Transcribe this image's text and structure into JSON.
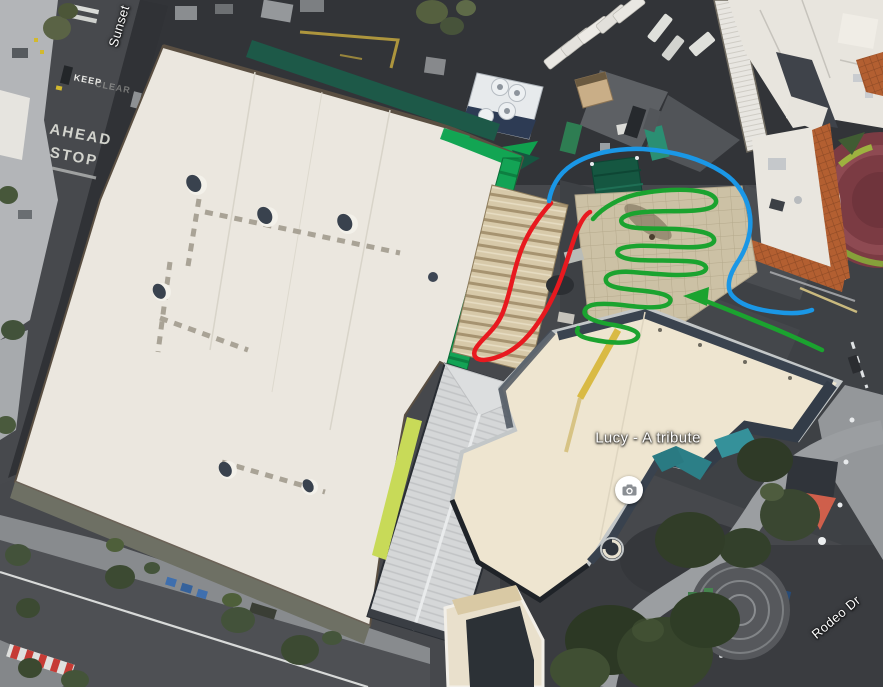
{
  "view": {
    "type": "satellite-imagery",
    "description": "Aerial map view with hand-drawn route annotations"
  },
  "labels": {
    "sunset_street": "Sunset",
    "rodeo_street": "Rodeo Dr",
    "poi_lucy": "Lucy - A tribute"
  },
  "road_markings": {
    "keep": "KEEP",
    "clear": "CLEAR",
    "ahead": "AHEAD",
    "stop": "STOP"
  },
  "icons": {
    "poi_photo": "camera-icon"
  },
  "annotations": {
    "colors": {
      "red": "#e8191f",
      "blue": "#1a97e6",
      "green": "#1ba32f"
    },
    "red_loop_path": "M551 203 C543 212 530 228 522 248 C513 270 511 292 503 312 C496 330 482 338 476 348 C472 355 475 360 484 360 C497 359 512 352 524 340 C537 327 549 307 557 288 C566 267 571 246 577 231 C582 219 586 214 590 212",
    "blue_route_path": "M549 201 C551 188 558 174 572 165 C590 153 617 148 643 149 C672 151 700 158 722 172 C738 182 748 198 750 216 C752 233 746 250 737 263 C730 274 726 285 731 294 C739 305 757 310 776 312 C791 314 804 313 812 310",
    "green_zigzag_path": "M593 219 C603 207 620 198 638 194 C658 190 685 188 703 192 C716 195 720 202 712 207 C700 213 668 210 645 212 C630 213 618 217 622 223 C628 230 652 228 675 229 C695 230 712 232 714 239 C716 246 700 248 678 247 C655 246 630 244 620 249 C613 253 620 259 638 260 C658 261 680 260 696 262 C707 264 710 270 700 273 C685 277 655 274 632 272 C616 271 604 274 606 281 C608 288 625 289 645 291 C662 293 673 296 670 302 C666 309 645 308 622 305 C603 303 588 303 585 310 C582 317 595 322 614 325 C630 328 642 332 637 338 C631 345 608 343 590 339 C580 337 575 333 578 328",
    "green_entry_path": "M822 350 C805 342 788 334 768 326 C748 318 720 306 700 299 L692 296",
    "green_arrowhead_points": "709,287 683,296 707,306"
  }
}
